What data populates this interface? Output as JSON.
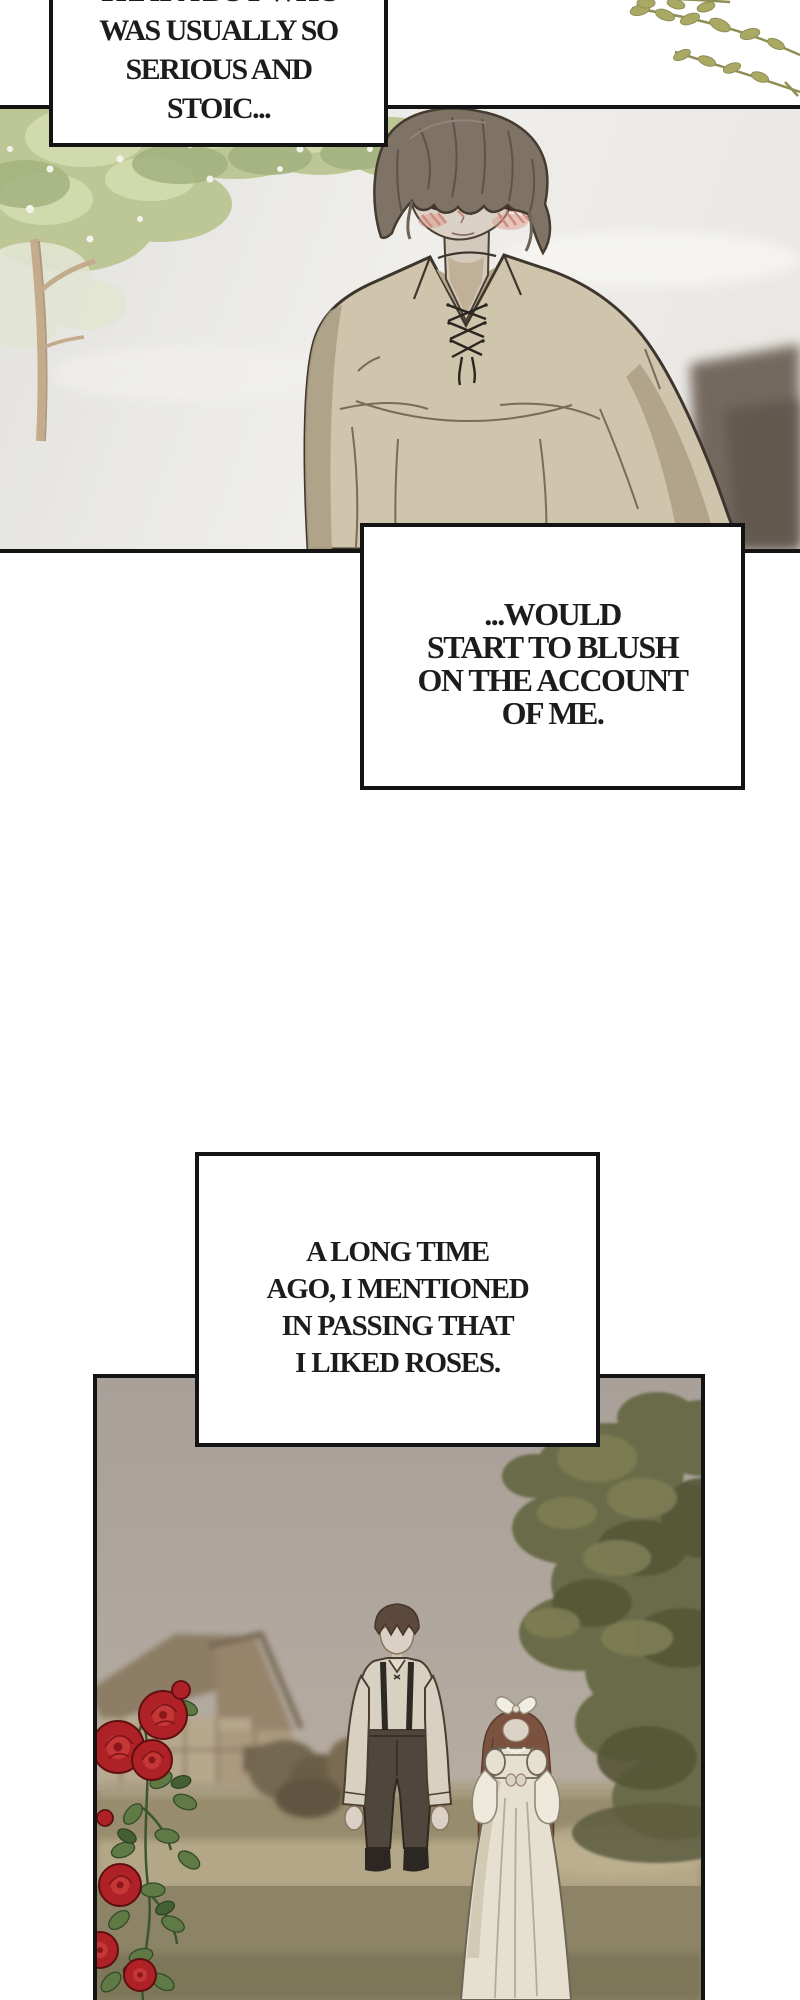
{
  "page": {
    "type": "webtoon-comic-page",
    "background": "#ffffff"
  },
  "captions": [
    {
      "id": "caption-1",
      "position": "top-left, clipped by top edge",
      "lines": [
        "THAT A BOY WHO",
        "WAS USUALLY SO",
        "SERIOUS AND",
        "STOIC..."
      ]
    },
    {
      "id": "caption-2",
      "position": "overlapping bottom of first panel",
      "lines": [
        "...WOULD",
        "START TO BLUSH",
        "ON THE ACCOUNT",
        "OF ME."
      ]
    },
    {
      "id": "caption-3",
      "position": "overlapping top of second panel",
      "lines": [
        "A LONG TIME",
        "AGO, I MENTIONED",
        "IN PASSING THAT",
        "I LIKED ROSES."
      ]
    }
  ],
  "panels": [
    {
      "id": "panel-1",
      "description": "Blushing boy with shaggy brown hair and red eyes, beige lace-up shirt, pale sky, green tree at left, olive sprigs in top-right margin"
    },
    {
      "id": "panel-2",
      "description": "Hazy countryside memory: farmhouse and red roses at left, boy in white shirt with suspenders beside girl in long white dress, large olive tree at right"
    }
  ],
  "palette": {
    "ink": "#141414",
    "text": "#1c1c1c",
    "panel1_sky": "#e9e8e4",
    "canopy_green": "#bcc795",
    "shirt_beige": "#cfc5ad",
    "hair_brown": "#7f7366",
    "blush_pink": "#cf8176",
    "eye_red": "#93302b",
    "sprig_olive": "#aaa964",
    "panel2_sky": "#a9a19a",
    "grass_olive": "#978c6d",
    "tree_olive": "#6b6c49",
    "rose_red": "#ae2126",
    "dress_cream": "#e6e0d1"
  }
}
